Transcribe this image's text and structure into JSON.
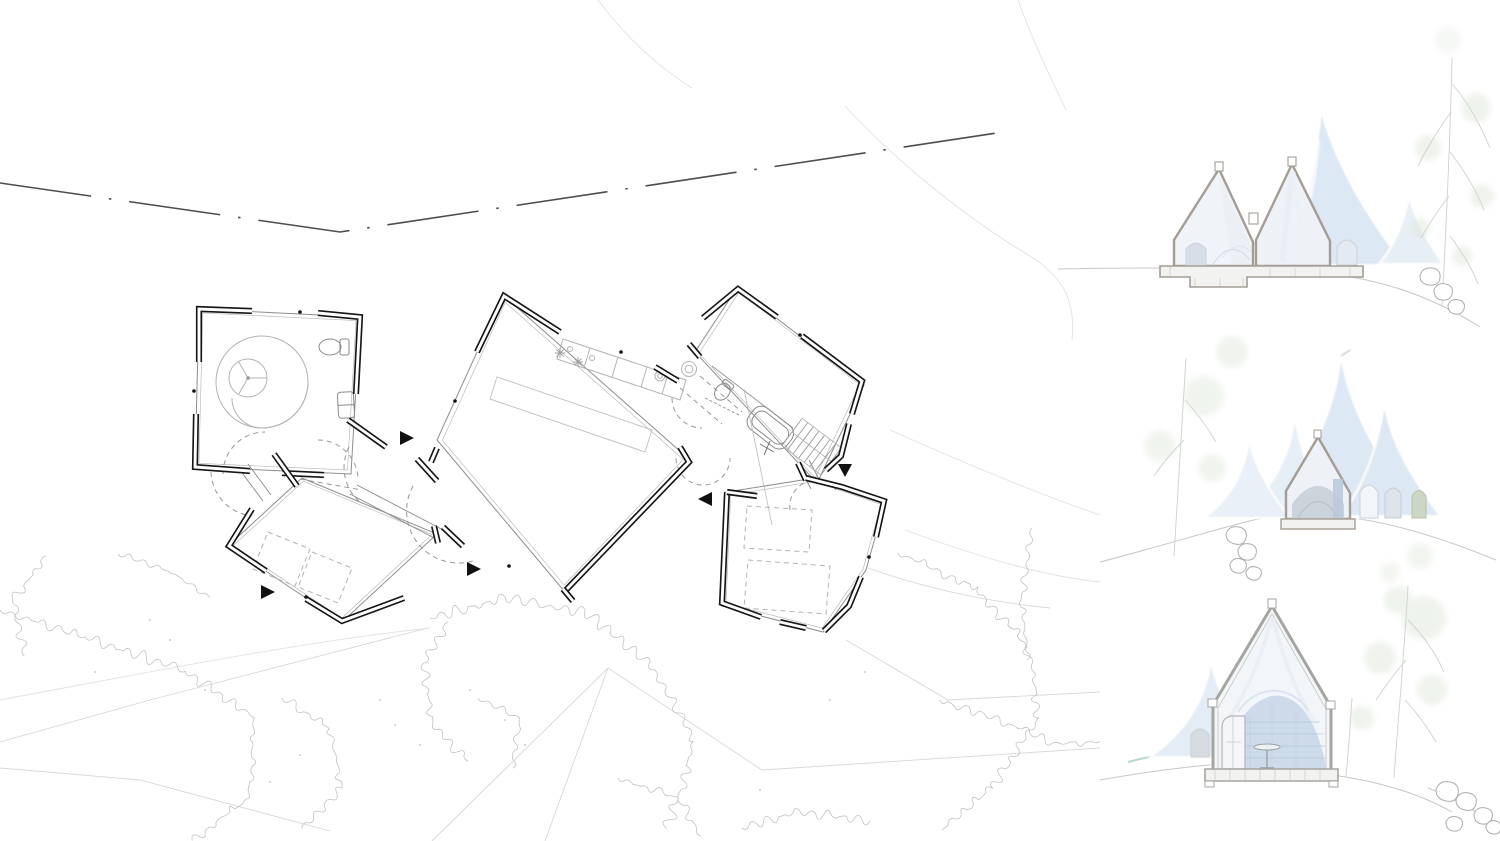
{
  "canvas": {
    "width": 1500,
    "height": 841,
    "background": "#ffffff"
  },
  "palette": {
    "wall_line": "#161616",
    "outline": "#8e8e8e",
    "inner_outline": "#b9b9b9",
    "furniture_line": "#b3b3b3",
    "fixture_line": "#8a8a8a",
    "dashed_line": "#979797",
    "contour_line": "#e2e2e4",
    "path_line": "#d8d8d8",
    "vegetation_line": "#c2c2c2",
    "speckle": "#bdbdbd",
    "road_line": "#4d4d4d",
    "marker_fill": "#111111",
    "cone_fill": "#dce8f3",
    "cone_fill_light": "#e7eff6",
    "cut_wall_line": "#a49d95",
    "section_wall_fill": "#f0f3f7",
    "arch_fill": "#d8dee8",
    "interior_dark": "#c8cfd8",
    "interior_blue": "#c4d5e7",
    "interior_band": "#aec3d8",
    "ground_line": "#c6c6c6",
    "rock_line": "#adadad",
    "tree_foliage": "#dbe5d5",
    "tree_branch": "#cdd2ce",
    "teal_accent": "#a9cfc6",
    "slab_fill": "#f2f2f0"
  },
  "plan": {
    "id": "site-floor-plan",
    "rooms": [
      {
        "id": "spiral-room",
        "features": [
          "spiral-stove",
          "toilet",
          "cabinet"
        ]
      },
      {
        "id": "west-cabin",
        "features": [
          "dashed-furniture"
        ]
      },
      {
        "id": "main-hall",
        "features": [
          "kitchen-counter",
          "long-table"
        ]
      },
      {
        "id": "bath-stair-wing",
        "features": [
          "bathtub",
          "toilet",
          "sink",
          "stair"
        ]
      },
      {
        "id": "east-cabin",
        "features": [
          "dashed-furniture"
        ]
      }
    ],
    "entry_markers": 5,
    "road": "dashed-centerline"
  },
  "sections": [
    {
      "id": "section-top",
      "cut_buildings": 2,
      "background_cones": 2,
      "has_tree_right": true,
      "has_rocks": true
    },
    {
      "id": "section-middle",
      "cut_buildings": 1,
      "background_cones": 4,
      "has_rocks": true
    },
    {
      "id": "section-bottom",
      "cut_buildings": 1,
      "background_cones": 1,
      "has_tree_right": true,
      "has_rocks": true
    }
  ]
}
